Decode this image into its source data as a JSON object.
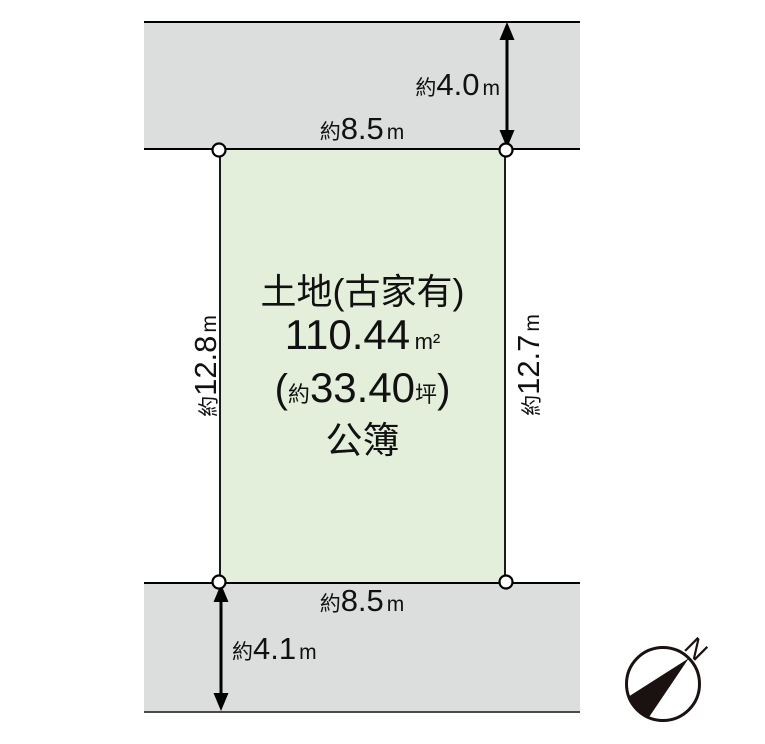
{
  "land": {
    "title": "土地(古家有)",
    "area_value": "110.44",
    "area_unit": "m²",
    "tsubo_open": "(",
    "tsubo_approx": "約",
    "tsubo_value": "33.40",
    "tsubo_unit": "坪",
    "tsubo_close": ")",
    "register": "公簿",
    "fill": "#e4efdb"
  },
  "roads": {
    "fill": "#dcdddd"
  },
  "dims": {
    "top_road": {
      "approx": "約",
      "value": "4.0",
      "unit": "m"
    },
    "top_edge": {
      "approx": "約",
      "value": "8.5",
      "unit": "m"
    },
    "left_edge": {
      "approx": "約",
      "value": "12.8",
      "unit": "m"
    },
    "right_edge": {
      "approx": "約",
      "value": "12.7",
      "unit": "m"
    },
    "bottom_edge": {
      "approx": "約",
      "value": "8.5",
      "unit": "m"
    },
    "bottom_road": {
      "approx": "約",
      "value": "4.1",
      "unit": "m"
    }
  },
  "compass": {
    "label": "N"
  },
  "colors": {
    "line": "#000000",
    "land_fill": "#e4efdb",
    "road_fill": "#dcdddd"
  }
}
